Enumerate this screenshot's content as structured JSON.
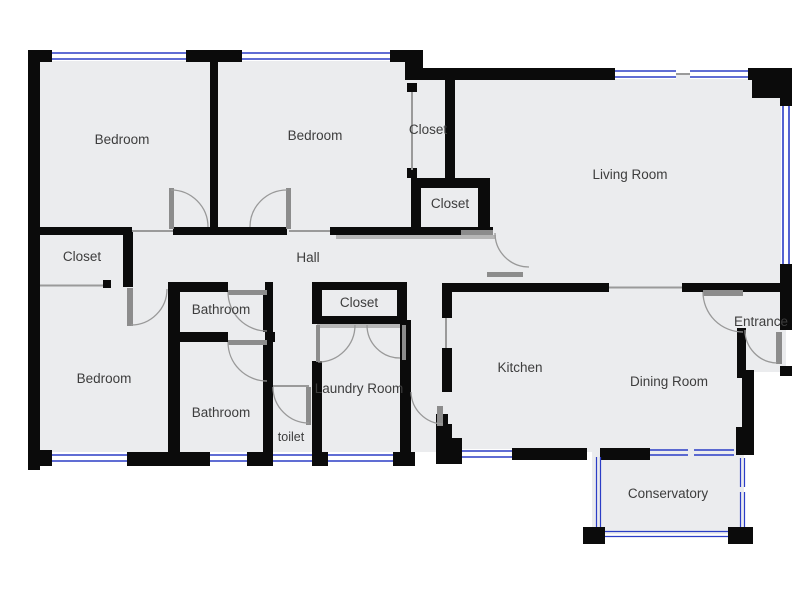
{
  "labels": {
    "bedroom1": "Bedroom",
    "bedroom2": "Bedroom",
    "bedroom3": "Bedroom",
    "closet_top": "Closet",
    "closet_hall": "Closet",
    "closet_left": "Closet",
    "closet_mid": "Closet",
    "hall": "Hall",
    "living": "Living Room",
    "bathroom1": "Bathroom",
    "bathroom2": "Bathroom",
    "toilet": "toilet",
    "laundry": "Laundry Room",
    "kitchen": "Kitchen",
    "dining": "Dining Room",
    "entrance": "Entrance",
    "conservatory": "Conservatory"
  },
  "colors": {
    "wall": "#0b0b0b",
    "floor": "#ebecee",
    "outside": "#ffffff",
    "window_glass": "#2b3dc6",
    "door_swing": "#999999",
    "door_leaf": "#8c8c8c",
    "label_text": "#3d3d3d"
  }
}
